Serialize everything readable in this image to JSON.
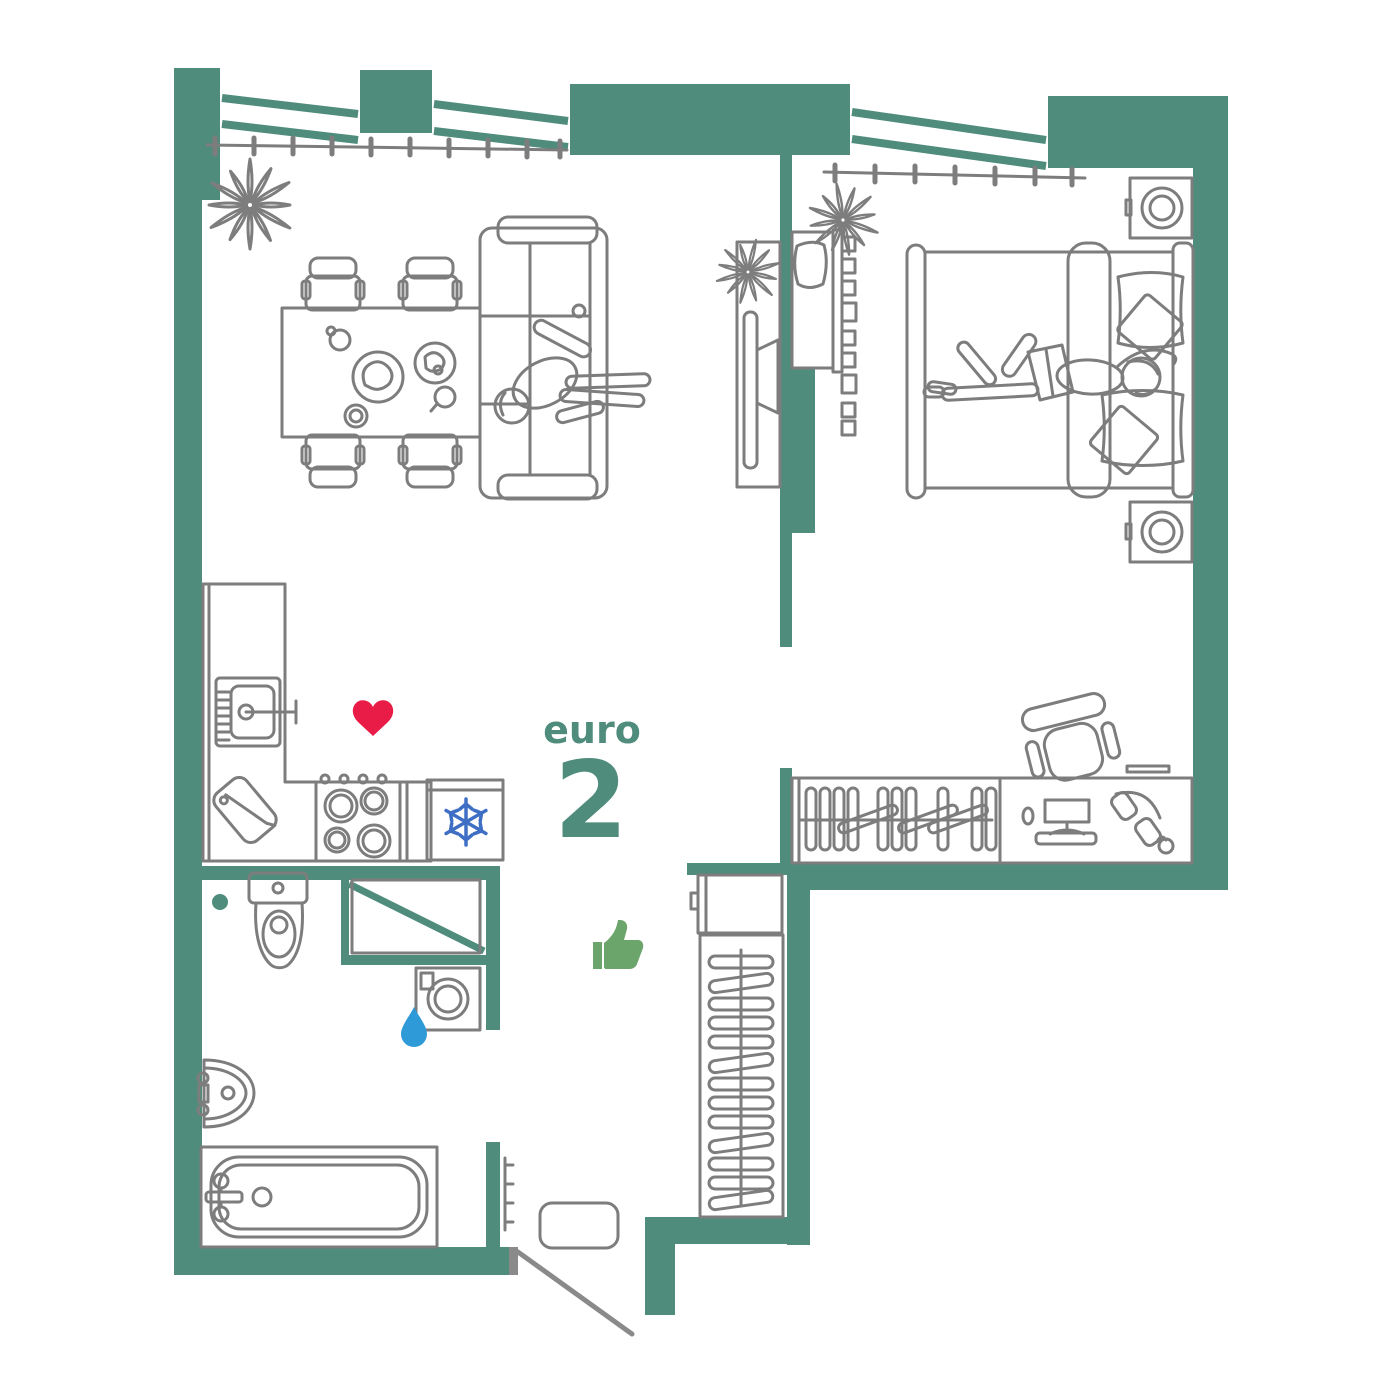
{
  "title": {
    "label": "euro",
    "number": "2"
  },
  "colors": {
    "wall": "#4f8c7c",
    "line": "#7d7d7d",
    "door": "#8a8a8a",
    "accent": "#4f8c7c",
    "heart": "#e81c46",
    "snowflake": "#3f6fc4",
    "thumb": "#6ba56b",
    "drop": "#2f9ad8"
  },
  "icons": {
    "heart": {
      "name": "heart-icon",
      "color": "#e81c46"
    },
    "snowflake": {
      "name": "snowflake-icon",
      "color": "#3f6fc4"
    },
    "thumbs_up": {
      "name": "thumbs-up-icon",
      "color": "#6ba56b"
    },
    "water_drop": {
      "name": "water-drop-icon",
      "color": "#2f9ad8"
    },
    "floor_dot": {
      "name": "floor-drain-dot",
      "color": "#4f8c7c"
    }
  }
}
